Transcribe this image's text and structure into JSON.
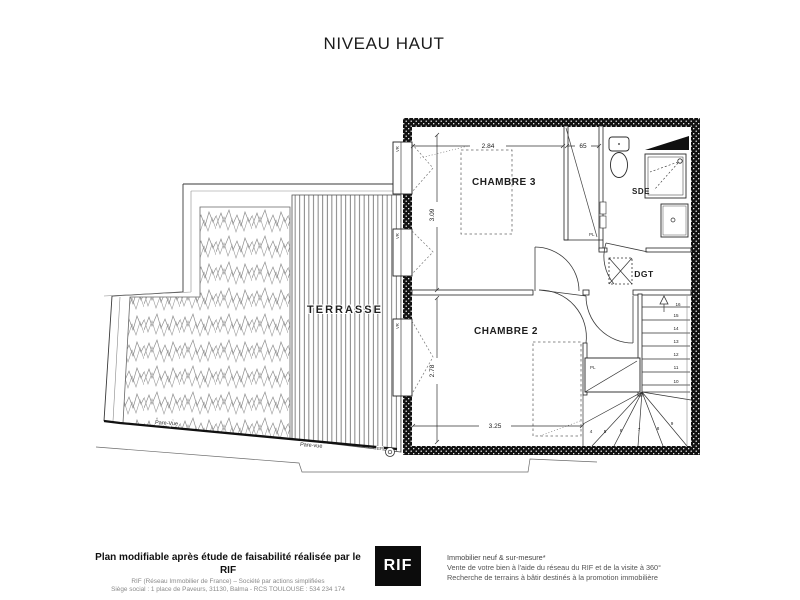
{
  "title": "NIVEAU HAUT",
  "plan": {
    "rooms": {
      "chambre3": "CHAMBRE 3",
      "chambre2": "CHAMBRE 2",
      "sde": "SDE",
      "dgt": "DGT",
      "terrasse": "TERRASSE"
    },
    "closets": {
      "upper": "PL",
      "lower": "PL"
    },
    "windows": {
      "w1": "VR",
      "w2": "VR",
      "w3": "VR"
    },
    "dimensions": {
      "chambre3_width_m": "2.84",
      "closet_width_cm": "65",
      "chambre3_depth_m": "3.09",
      "chambre2_depth_m": "2.78",
      "chambre2_width_m": "3.25"
    },
    "stairs": [
      "4",
      "5",
      "6",
      "7",
      "8",
      "9",
      "10",
      "11",
      "12",
      "13",
      "14",
      "15",
      "16"
    ],
    "annotations": {
      "pare_vue_left": "Pare-Vue",
      "pare_vue_right": "Pare-vue",
      "ep": "EP"
    }
  },
  "footer": {
    "left": {
      "line1": "Plan modifiable après étude de faisabilité réalisée par le RIF",
      "line2": "RIF (Réseau Immobilier de France) – Société par actions simplifiées",
      "line3": "Siège social : 1 place de Paveurs, 31130, Balma - RCS TOULOUSE : 534 234 174"
    },
    "logo": "RIF",
    "right": {
      "line1": "Immobilier neuf & sur-mesure*",
      "line2": "Vente de votre bien à l'aide du réseau du RIF et de la visite à 360°",
      "line3": "Recherche de terrains à bâtir destinés à la promotion immobilière"
    }
  }
}
